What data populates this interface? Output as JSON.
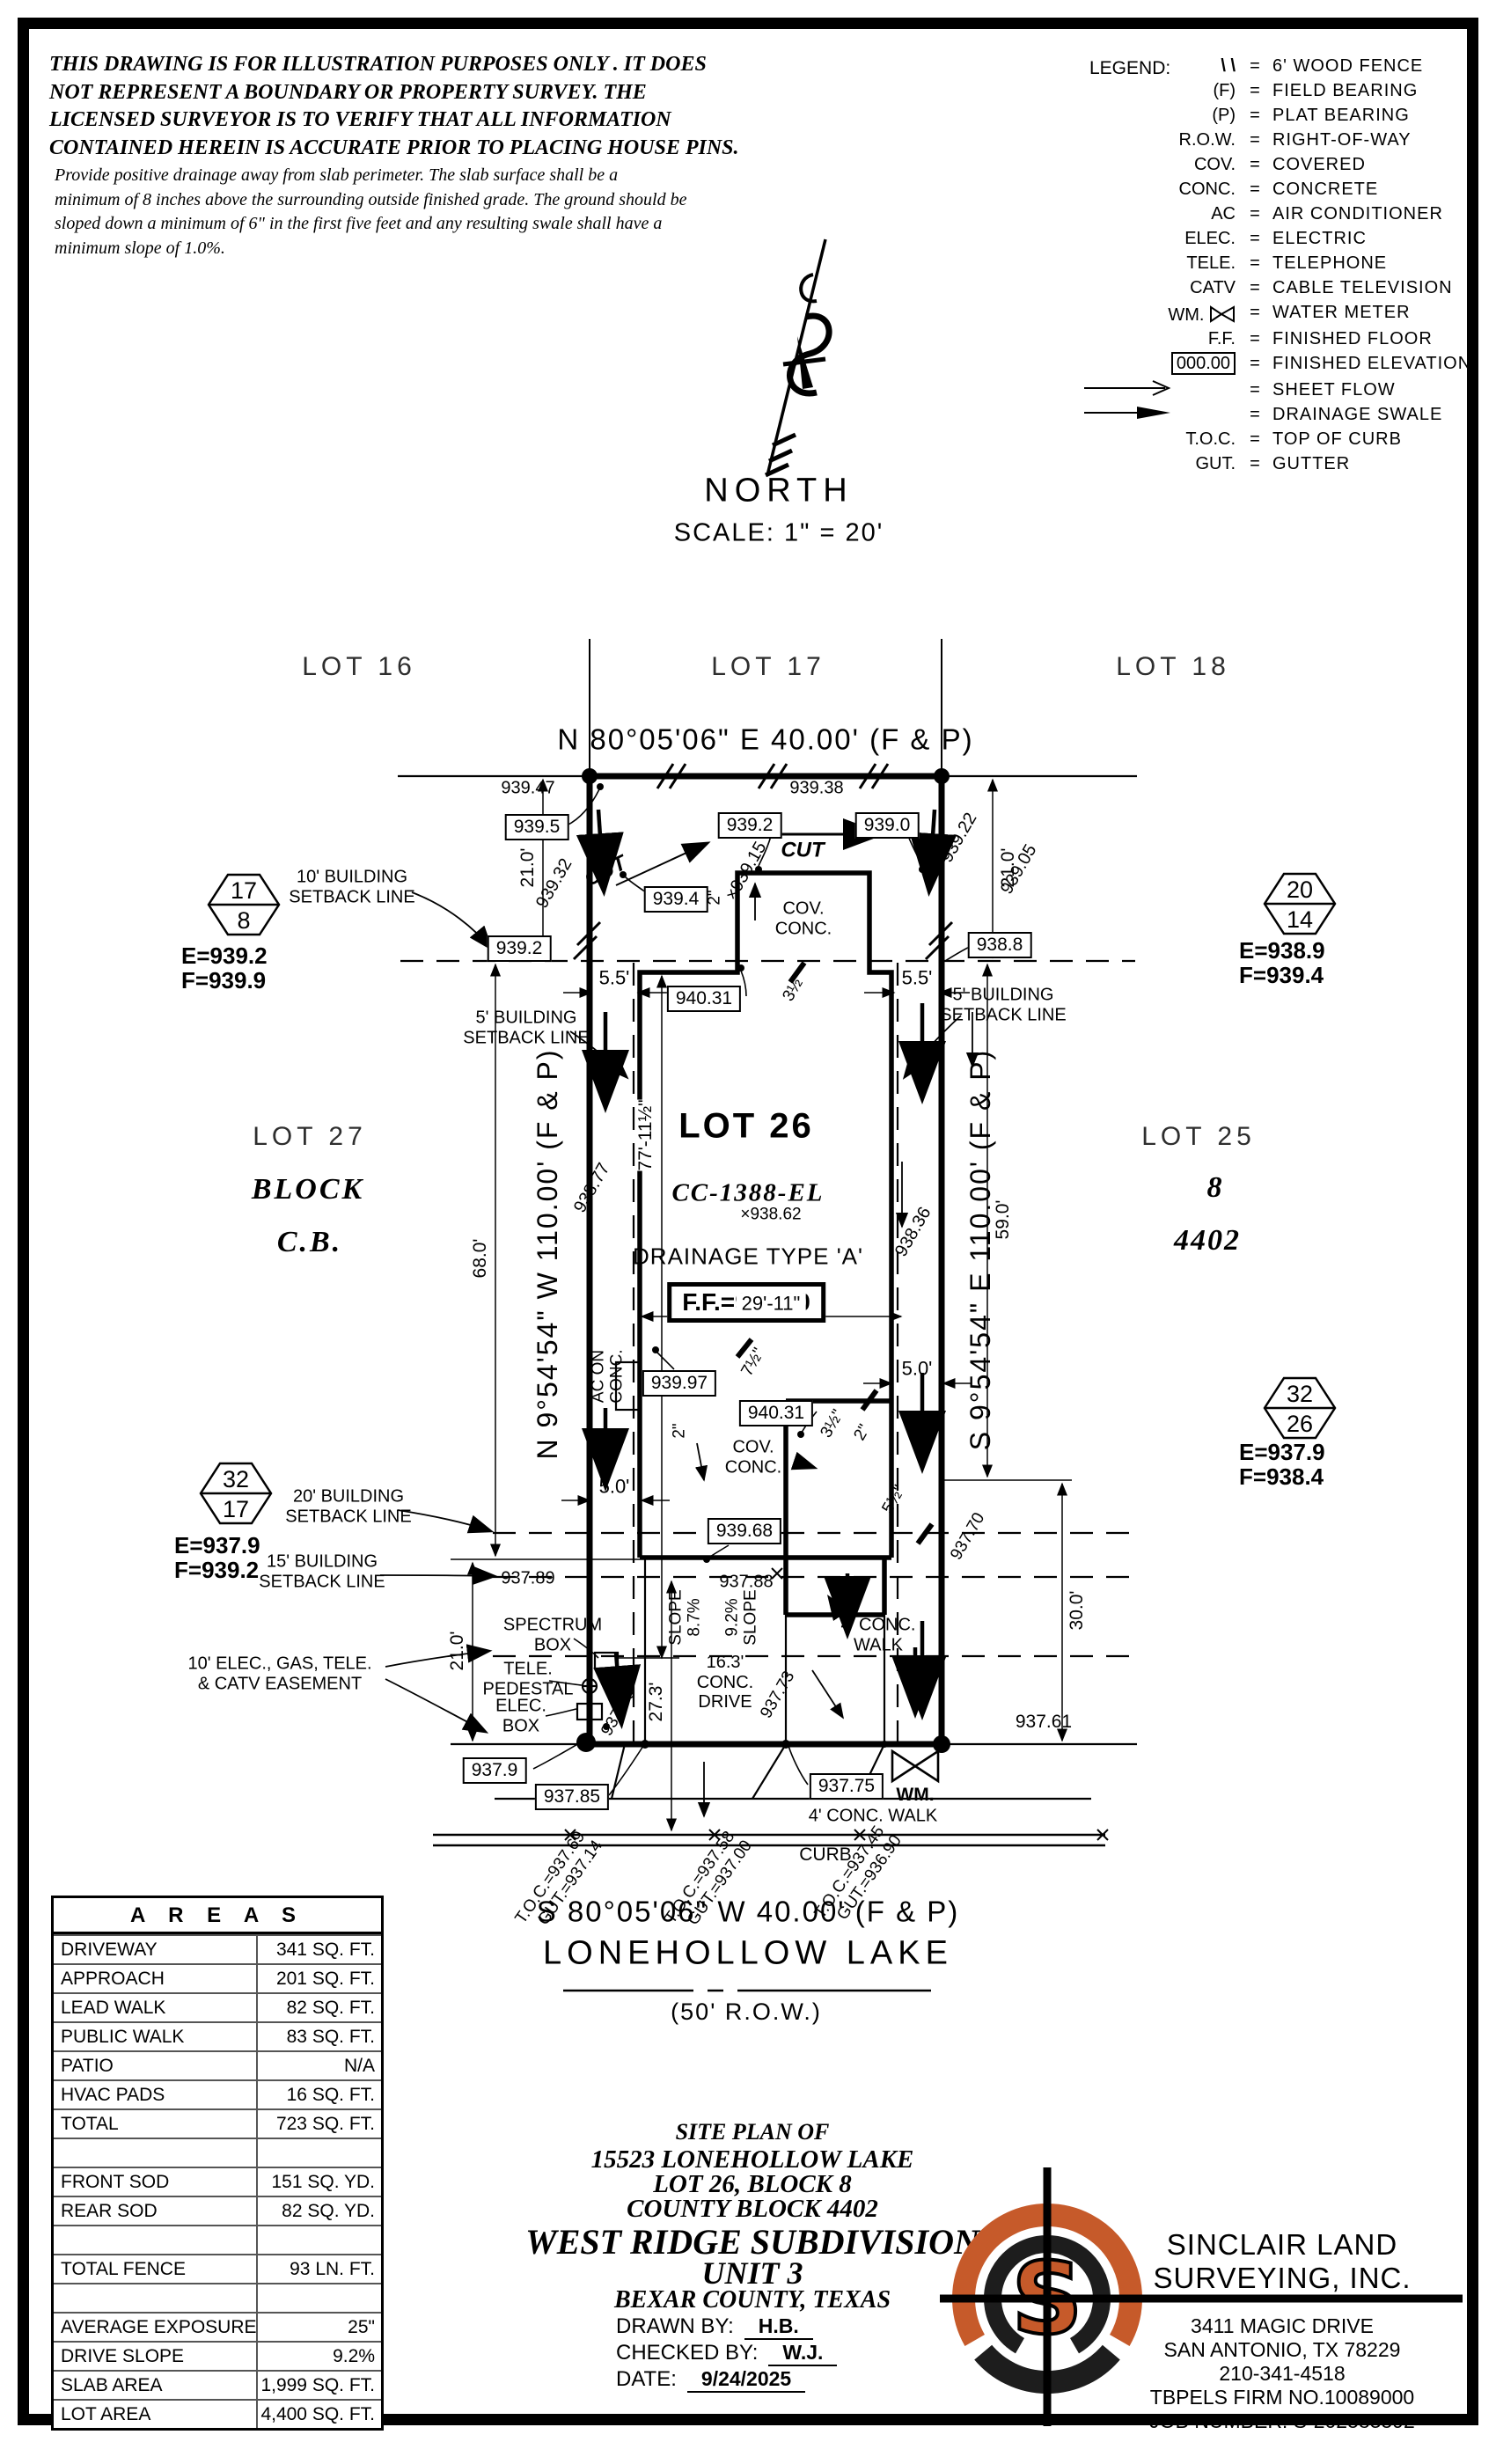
{
  "disclaimer": {
    "para1": "THIS DRAWING IS FOR ILLUSTRATION PURPOSES ONLY . IT DOES\nNOT REPRESENT A BOUNDARY OR PROPERTY SURVEY. THE\nLICENSED SURVEYOR IS TO VERIFY THAT ALL INFORMATION\nCONTAINED HEREIN IS ACCURATE PRIOR TO PLACING HOUSE PINS.",
    "para2": "Provide positive drainage away from slab perimeter. The slab surface shall be a\nminimum of 8 inches above the surrounding outside finished grade. The ground should be\nsloped down a minimum of 6\" in the first five feet and any resulting swale shall have a\nminimum slope of 1.0%."
  },
  "legend": {
    "title": "LEGEND:",
    "eq": "=",
    "items": [
      {
        "sym": "\\ \\",
        "label": "6' WOOD FENCE"
      },
      {
        "sym": "(F)",
        "label": "FIELD BEARING"
      },
      {
        "sym": "(P)",
        "label": "PLAT BEARING"
      },
      {
        "sym": "R.O.W.",
        "label": "RIGHT-OF-WAY"
      },
      {
        "sym": "COV.",
        "label": "COVERED"
      },
      {
        "sym": "CONC.",
        "label": "CONCRETE"
      },
      {
        "sym": "AC",
        "label": "AIR CONDITIONER"
      },
      {
        "sym": "ELEC.",
        "label": "ELECTRIC"
      },
      {
        "sym": "TELE.",
        "label": "TELEPHONE"
      },
      {
        "sym": "CATV",
        "label": "CABLE TELEVISION"
      },
      {
        "sym": "WM.",
        "label": "WATER METER"
      },
      {
        "sym": "F.F.",
        "label": "FINISHED FLOOR"
      },
      {
        "sym": "000.00",
        "label": "FINISHED ELEVATION"
      },
      {
        "sym": "",
        "label": "SHEET FLOW"
      },
      {
        "sym": "",
        "label": "DRAINAGE SWALE"
      },
      {
        "sym": "T.O.C.",
        "label": "TOP OF CURB"
      },
      {
        "sym": "GUT.",
        "label": "GUTTER"
      }
    ]
  },
  "north": {
    "label": "NORTH",
    "scale": "SCALE: 1\" = 20'"
  },
  "plat": {
    "lot16": "LOT 16",
    "lot17": "LOT 17",
    "lot18": "LOT 18",
    "lot27": "LOT 27",
    "block_word": "BLOCK",
    "cb": "C.B.",
    "lot25": "LOT 25",
    "blk8": "8",
    "cb4402": "4402",
    "lot26": "LOT 26",
    "brg_top": "N 80°05'06\" E 40.00' (F & P)",
    "brg_bottom": "S 80°05'06\" W 40.00' (F & P)",
    "brg_left": "N 9°54'54\" W 110.00' (F & P)",
    "brg_right": "S 9°54'54\" E 110.00' (F & P)",
    "street": "LONEHOLLOW LAKE",
    "row50": "(50' R.O.W.)",
    "cc": "CC-1388-EL",
    "spot86": "×938.62",
    "dtype": "DRAINAGE TYPE 'A'",
    "ff": "F.F.=940.60",
    "cut": "CUT",
    "e9947": "939.47",
    "e9938": "939.38",
    "e9922": "939.22",
    "e9905": "939.05",
    "e9915": "×939.15",
    "e9932": "939.32",
    "e8877": "938.77",
    "e8836": "938.36",
    "e789": "937.89",
    "e788": "937.88",
    "e773": "937.73",
    "e770": "937.70",
    "e761": "937.61",
    "b995": "939.5",
    "b992t": "939.2",
    "b990": "939.0",
    "b994": "939.4",
    "b992l": "939.2",
    "b988": "938.8",
    "b4031": "940.31",
    "b9997": "939.97",
    "b9968": "939.68",
    "b79": "937.9",
    "b785": "937.85",
    "b775": "937.75",
    "sb10": "10' BUILDING\nSETBACK LINE",
    "sb5": "5' BUILDING\nSETBACK LINE",
    "sb20": "20' BUILDING\nSETBACK LINE",
    "sb15": "15' BUILDING\nSETBACK LINE",
    "easement": "10' ELEC., GAS, TELE.\n& CATV EASEMENT",
    "d21": "21.0'",
    "d68": "68.0'",
    "d59": "59.0'",
    "d30": "30.0'",
    "d273": "27.3'",
    "d55": "5.5'",
    "d50": "5.0'",
    "d77": "77'-11½\"",
    "d29": "29'-11\"",
    "d2": "2\"",
    "d35": "3½\"",
    "d75": "7½\"",
    "d5h": "5½\"",
    "cov": "COV.\nCONC.",
    "ac": "AC ON\nCONC.",
    "spectrum": "SPECTRUM\nBOX",
    "tele": "TELE.\nPEDESTAL",
    "elec": "ELEC.\nBOX",
    "slope1": "SLOPE\n8.7%",
    "slope2": "9.2%\nSLOPE",
    "drive": "16.3'\nCONC.\nDRIVE",
    "walk": "4' CONC.\nWALK",
    "walk2": "4' CONC. WALK",
    "curb": "CURB",
    "wm": "WM.",
    "toc1": "T.O.C.=937.69",
    "gut1": "GUT.=937.14",
    "toc2": "T.O.C.=937.58",
    "gut2": "GUT.=937.00",
    "toc3": "T.O.C.=937.45",
    "gut3": "GUT.=936.90",
    "hex1t": "17",
    "hex1b": "8",
    "hex1e": "E=939.2",
    "hex1f": "F=939.9",
    "hex2t": "20",
    "hex2b": "14",
    "hex2e": "E=938.9",
    "hex2f": "F=939.4",
    "hex3t": "32",
    "hex3b": "17",
    "hex3e": "E=937.9",
    "hex3f": "F=939.2",
    "hex4t": "32",
    "hex4b": "26",
    "hex4e": "E=937.9",
    "hex4f": "F=938.4"
  },
  "areas": {
    "title": "A R E A S",
    "rows": [
      {
        "label": "DRIVEWAY",
        "value": "341 SQ. FT."
      },
      {
        "label": "APPROACH",
        "value": "201 SQ. FT."
      },
      {
        "label": "LEAD WALK",
        "value": "82 SQ. FT."
      },
      {
        "label": "PUBLIC WALK",
        "value": "83 SQ. FT."
      },
      {
        "label": "PATIO",
        "value": "N/A"
      },
      {
        "label": "HVAC PADS",
        "value": "16 SQ. FT."
      },
      {
        "label": "TOTAL",
        "value": "723 SQ. FT."
      },
      {
        "label": "",
        "value": ""
      },
      {
        "label": "FRONT SOD",
        "value": "151 SQ. YD."
      },
      {
        "label": "REAR SOD",
        "value": "82 SQ. YD."
      },
      {
        "label": "",
        "value": ""
      },
      {
        "label": "TOTAL FENCE",
        "value": "93 LN. FT."
      },
      {
        "label": "",
        "value": ""
      },
      {
        "label": "AVERAGE EXPOSURE",
        "value": "25\""
      },
      {
        "label": "DRIVE SLOPE",
        "value": "9.2%"
      },
      {
        "label": "SLAB AREA",
        "value": "1,999 SQ. FT."
      },
      {
        "label": "LOT AREA",
        "value": "4,400 SQ. FT."
      }
    ]
  },
  "title_block": {
    "l1": "SITE PLAN OF",
    "l2": "15523 LONEHOLLOW LAKE",
    "l3": "LOT 26, BLOCK 8",
    "l4": "COUNTY BLOCK 4402",
    "l5": "WEST RIDGE SUBDIVISION",
    "l6": "UNIT 3",
    "l7": "BEXAR COUNTY, TEXAS",
    "drawn_label": "DRAWN BY:",
    "drawn": "H.B.",
    "checked_label": "CHECKED BY:",
    "checked": "W.J.",
    "date_label": "DATE:",
    "date": "9/24/2025"
  },
  "company": {
    "name1": "SINCLAIR LAND",
    "name2": "SURVEYING, INC.",
    "addr1": "3411 MAGIC DRIVE",
    "addr2": "SAN ANTONIO, TX 78229",
    "phone": "210-341-4518",
    "firm": "TBPELS FIRM NO.10089000",
    "job": "JOB NUMBER: S-202583592",
    "letter": "S",
    "orange": "#C65A2A"
  }
}
